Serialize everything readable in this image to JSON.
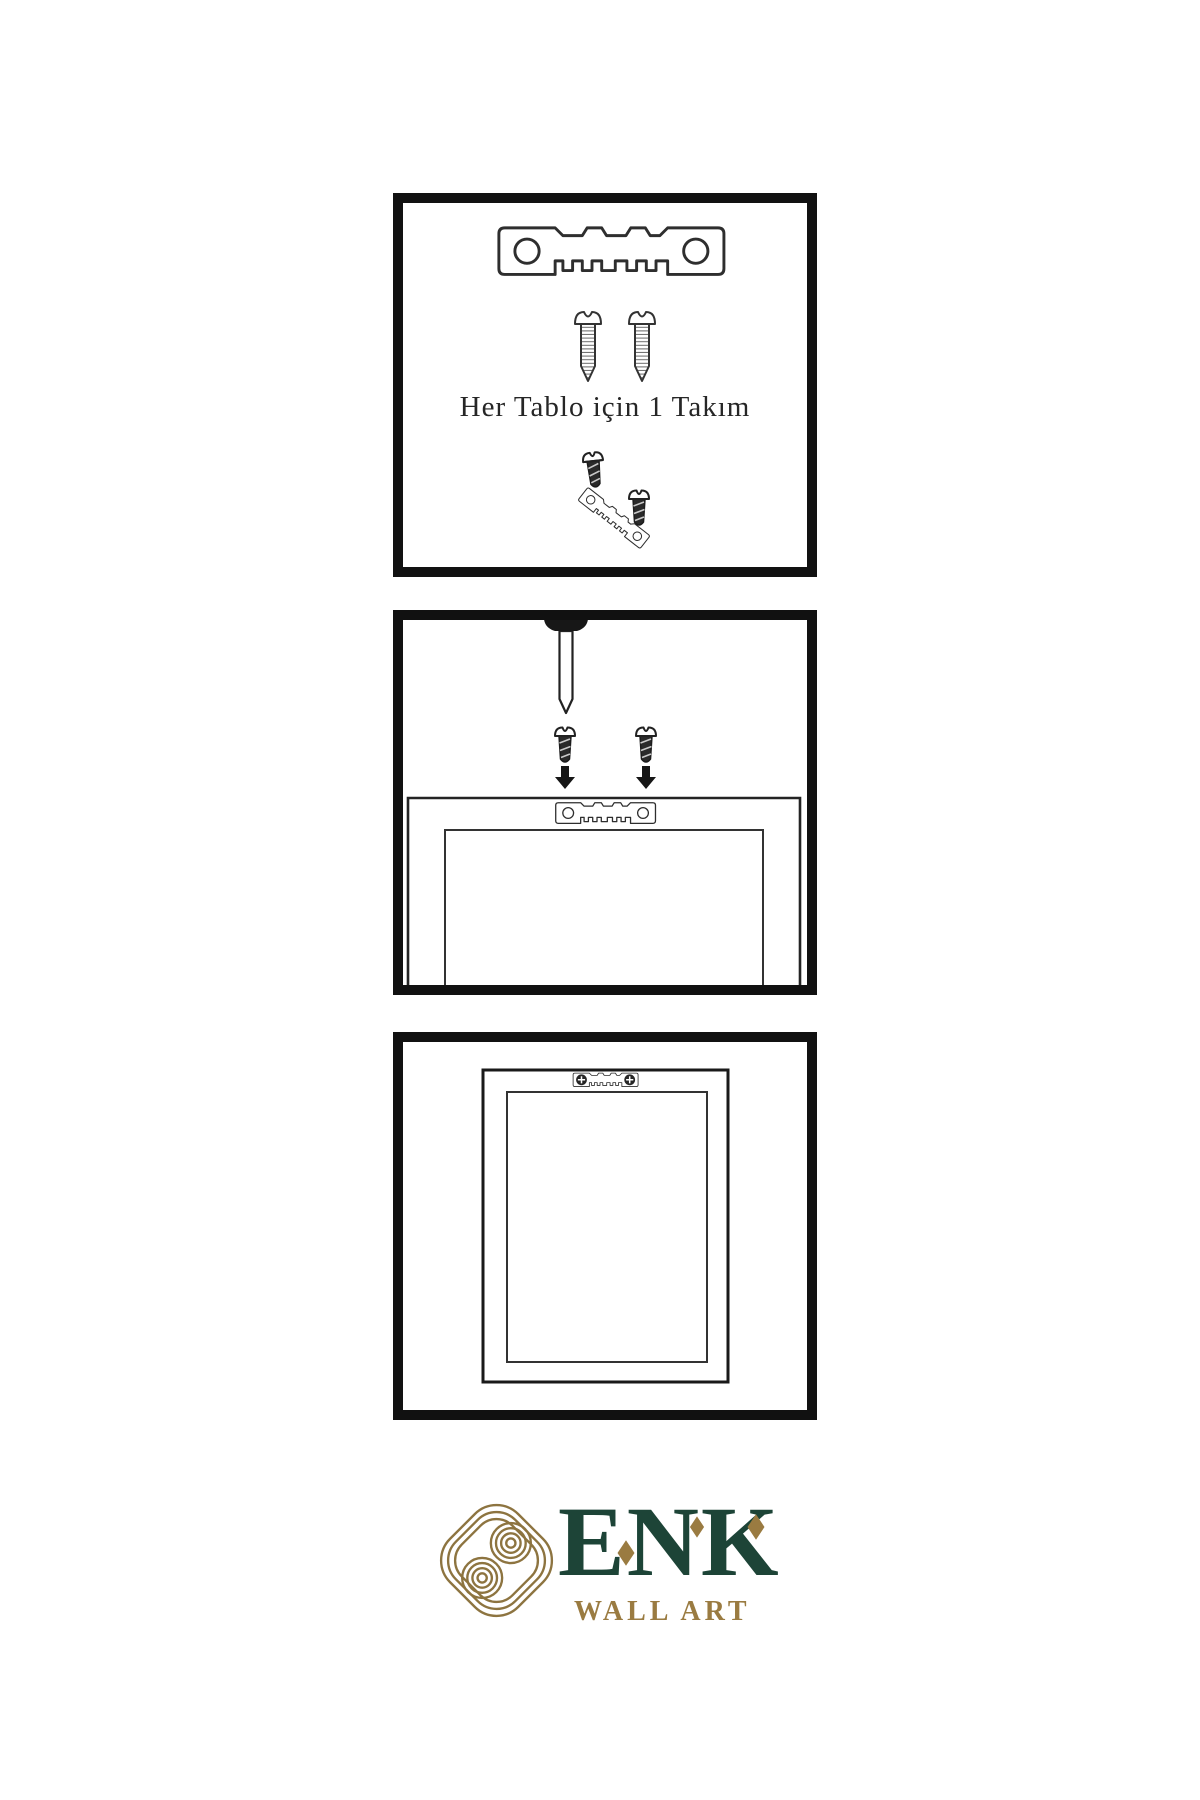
{
  "page": {
    "background": "#ffffff"
  },
  "colors": {
    "panel_border": "#111111",
    "illustration_line": "#2e2e2e",
    "hardware_dark": "#262626",
    "brand_green": "#1d4437",
    "brand_gold": "#9a7b41",
    "knot_gold": "#8d7440"
  },
  "panels": [
    {
      "name": "hardware-kit",
      "caption": "Her Tablo için 1 Takım",
      "contents": [
        "sawtooth-hanger-icon",
        "screw-icon",
        "screw-icon",
        "screw-into-hanger-icon"
      ]
    },
    {
      "name": "mounting-steps",
      "contents": [
        "wall-nail-icon",
        "screw-icon",
        "screw-icon",
        "arrow-down-icon",
        "arrow-down-icon",
        "frame-back-with-hanger-icon"
      ]
    },
    {
      "name": "hanging-result",
      "contents": [
        "framed-picture-back-icon",
        "installed-sawtooth-hanger-icon"
      ]
    }
  ],
  "logo": {
    "icon": "knot-icon",
    "brand": "ENK",
    "subtitle": "WALL ART"
  }
}
